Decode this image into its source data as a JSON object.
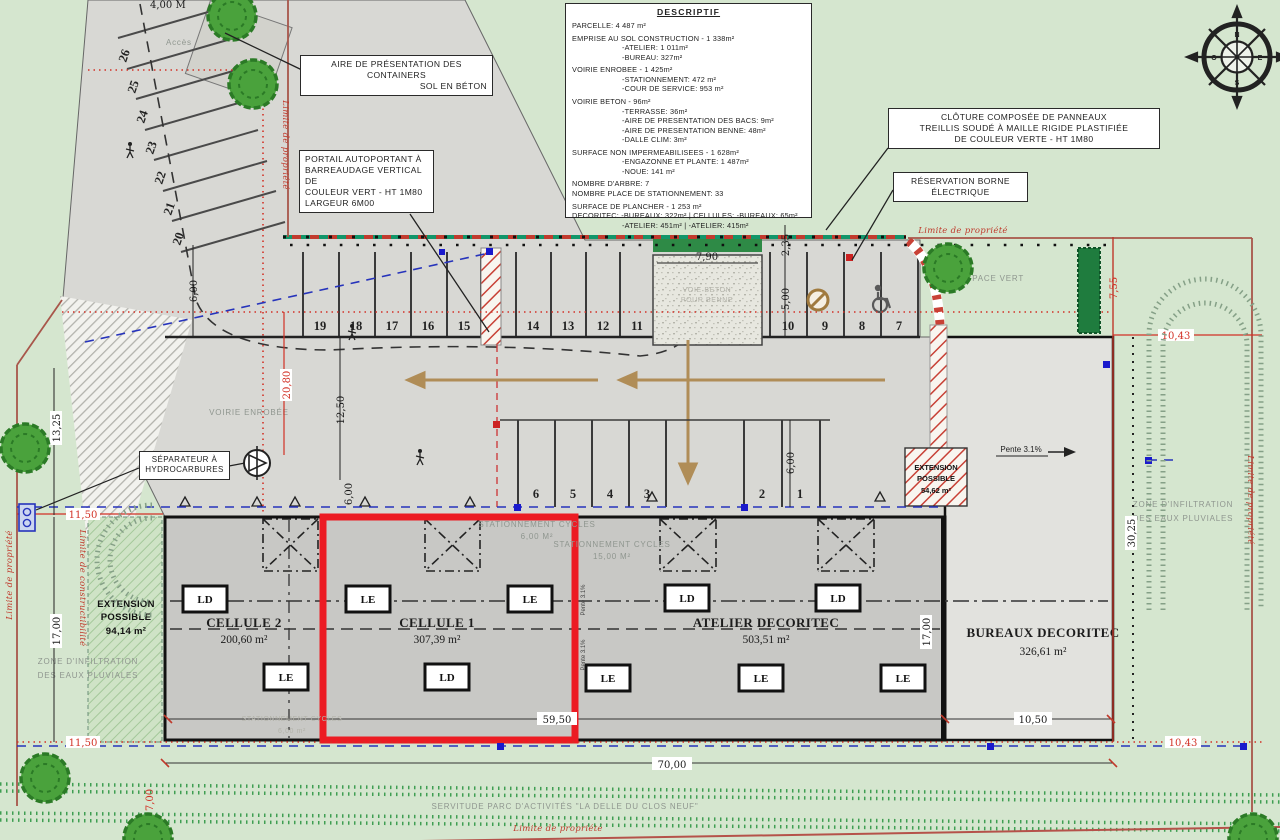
{
  "descriptif": {
    "title": "DESCRIPTIF",
    "lines": [
      "PARCELLE: 4 487 m²",
      "EMPRISE AU SOL CONSTRUCTION - 1 338m²",
      "-ATELIER: 1 011m²",
      "-BUREAU: 327m²",
      "VOIRIE ENROBEE - 1 425m²",
      "-STATIONNEMENT: 472 m²",
      "-COUR DE SERVICE: 953 m²",
      "VOIRIE BETON - 96m²",
      "-TERRASSE: 36m²",
      "-AIRE DE PRESENTATION DES BACS: 9m²",
      "-AIRE DE PRESENTATION BENNE: 48m²",
      "-DALLE CLIM: 3m²",
      "SURFACE NON IMPERMEABILISEES - 1 628m²",
      "-ENGAZONNE ET PLANTE: 1 487m²",
      "-NOUE: 141 m²",
      "NOMBRE D'ARBRE: 7",
      "NOMBRE PLACE DE STATIONNEMENT: 33",
      "SURFACE DE PLANCHER - 1 253 m²",
      "DECORITEC: -BUREAUX: 322m²   |   CELLULES: -BUREAUX: 65m²",
      "-ATELIER: 451m²   |   -ATELIER: 415m²"
    ]
  },
  "labels": {
    "containers_l1": "AIRE DE PRÉSENTATION DES CONTAINERS",
    "containers_l2": "SOL EN BÉTON",
    "portail_l1": "PORTAIL AUTOPORTANT À",
    "portail_l2": "BARREAUDAGE VERTICAL DE",
    "portail_l3": "COULEUR VERT - HT 1M80",
    "portail_l4": "LARGEUR 6M00",
    "cloture_l1": "CLÔTURE COMPOSÉE DE PANNEAUX",
    "cloture_l2": "TREILLIS SOUDÉ À MAILLE RIGIDE PLASTIFIÉE",
    "cloture_l3": "DE COULEUR VERTE - HT 1M80",
    "borne_l1": "RÉSERVATION BORNE",
    "borne_l2": "ÉLECTRIQUE",
    "separateur_l1": "SÉPARATEUR À",
    "separateur_l2": "HYDROCARBURES"
  },
  "site_texts": {
    "acces": "Accès",
    "voirie": "VOIRIE ENROBÉE",
    "espace_vert": "ESPACE VERT",
    "zone_infiltration_l1": "ZONE D'INFILTRATION",
    "zone_infiltration_l2": "DES EAUX PLUVIALES",
    "cycles": "STATIONNEMENT CYCLES",
    "cycles_a": "6,00 M²",
    "cycles_b": "15,00 M²",
    "cycles_c": "6,00 m²",
    "benne_l1": "VOIE BETON",
    "benne_l2": "POUR BENNE",
    "servitude": "SERVITUDE PARC D'ACTIVITÉS \"LA DELLE DU CLOS NEUF\"",
    "limite_propriete": "Limite de propriété",
    "limite_constructibilite": "Limite de constructibilité",
    "pente": "Pente 3.1%"
  },
  "building": {
    "cellule2": {
      "name": "CELLULE 2",
      "area": "200,60 m²"
    },
    "cellule1": {
      "name": "CELLULE 1",
      "area": "307,39 m²"
    },
    "atelier": {
      "name": "ATELIER DECORITEC",
      "area": "503,51 m²"
    },
    "bureaux": {
      "name": "BUREAUX DECORITEC",
      "area": "326,61 m²"
    },
    "ext_left": {
      "l1": "EXTENSION",
      "l2": "POSSIBLE",
      "area": "94,14 m²"
    },
    "ext_right": {
      "l1": "EXTENSION",
      "l2": "POSSIBLE",
      "area": "54,62 m²"
    },
    "tags": [
      "LD",
      "LE",
      "LE",
      "LE",
      "LD",
      "LD",
      "LD",
      "LE",
      "LE",
      "LE"
    ]
  },
  "dimensions": {
    "d600a": "6,00",
    "d2080": "20,80",
    "d1250": "12,50",
    "d235": "2,35",
    "d500": "5,00",
    "d600b": "6,00",
    "d600c": "6,00",
    "d790": "7,90",
    "d5950": "59,50",
    "d7000": "70,00",
    "d1050": "10,50",
    "d1700l": "17,00",
    "d1700r": "17,00",
    "d1325": "13,25",
    "d3025": "30,25",
    "d755": "7,55",
    "d1043a": "10,43",
    "d1043b": "10,43",
    "d1150a": "11,50",
    "d1150b": "11,50",
    "d700": "7,00",
    "d400": "4,00 M"
  },
  "parking": {
    "row1": [
      "19",
      "18",
      "17",
      "16",
      "15",
      "14",
      "13",
      "12",
      "11",
      "10",
      "9",
      "8",
      "7"
    ],
    "row2": [
      "6",
      "5",
      "4",
      "3",
      "2",
      "1"
    ],
    "diagonal": [
      "26",
      "25",
      "24",
      "23",
      "22",
      "21",
      "20"
    ]
  },
  "compass": {
    "n": "N",
    "e": "E",
    "s": "S",
    "o": "O"
  }
}
